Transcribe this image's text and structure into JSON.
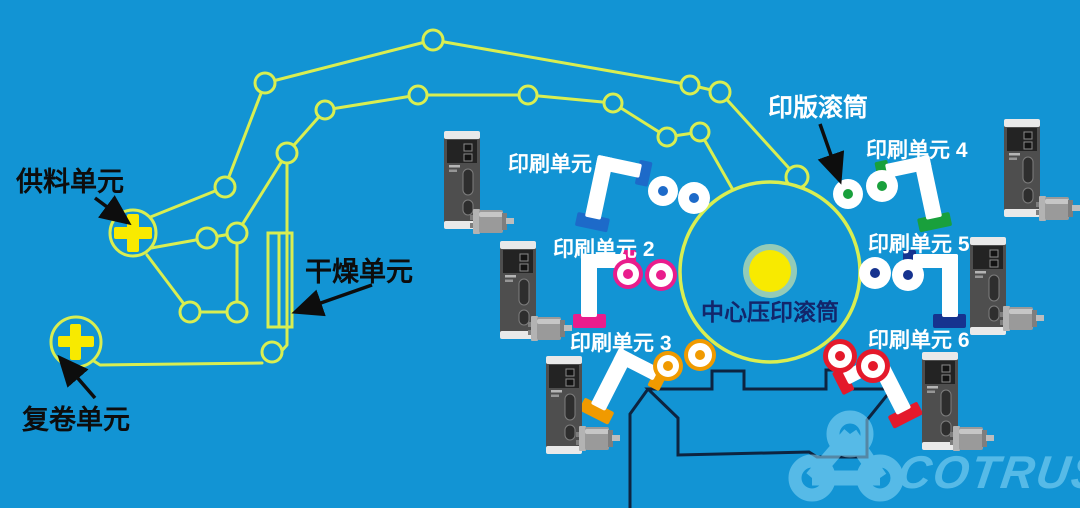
{
  "labels": {
    "supply_unit": "供料单元",
    "rewind_unit": "复卷单元",
    "drying_unit": "干燥单元",
    "plate_cylinder": "印版滚筒",
    "central_cylinder": "中心压印滚筒",
    "logo": "COTRUST"
  },
  "units": [
    {
      "label": "印刷单元 1",
      "color": "#1d6ac9",
      "ring": "#ffffff"
    },
    {
      "label": "印刷单元 2",
      "color": "#e91d8c",
      "ring": "#e91d8c"
    },
    {
      "label": "印刷单元 3",
      "color": "#f09a00",
      "ring": "#f09a00"
    },
    {
      "label": "印刷单元 4",
      "color": "#19a03c",
      "ring": "#ffffff"
    },
    {
      "label": "印刷单元 5",
      "color": "#16338f",
      "ring": "#ffffff"
    },
    {
      "label": "印刷单元 6",
      "color": "#e4192b",
      "ring": "#e4192b"
    }
  ],
  "colors": {
    "background": "#1294d4",
    "web_path": "#d9ee51",
    "reel_plus": "#f8ea00",
    "machine_frame": "#0d2440",
    "watermark": "#8fd9f8",
    "central_label_text": "#12266b",
    "black_labels": "#0d0d0d",
    "white_labels": "#ffffff"
  }
}
